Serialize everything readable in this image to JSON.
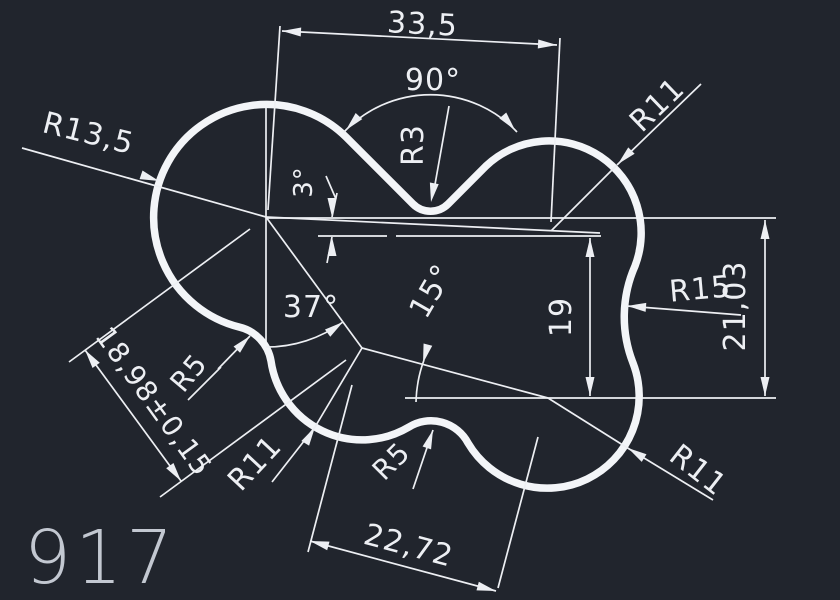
{
  "drawing": {
    "part_number": "917",
    "labels": {
      "dim_33_5": "33,5",
      "angle_90": "90°",
      "radius_r3": "R3",
      "radius_r11_top_right": "R11",
      "radius_r13_5": "R13,5",
      "angle_3": "3°",
      "angle_37": "37°",
      "angle_15": "15°",
      "dim_19": "19",
      "radius_r15": "R15",
      "dim_21_03": "21,03",
      "radius_r5_left": "R5",
      "radius_r11_bottom_left": "R11",
      "radius_r5_bottom": "R5",
      "dim_18_98": "18,98±0,15",
      "dim_22_72": "22,72",
      "radius_r11_bottom_right": "R11"
    },
    "colors": {
      "background": "#21252d",
      "line": "#edeff3",
      "outline": "#f3f5f8",
      "part_number_text": "#c3c8d1"
    }
  }
}
